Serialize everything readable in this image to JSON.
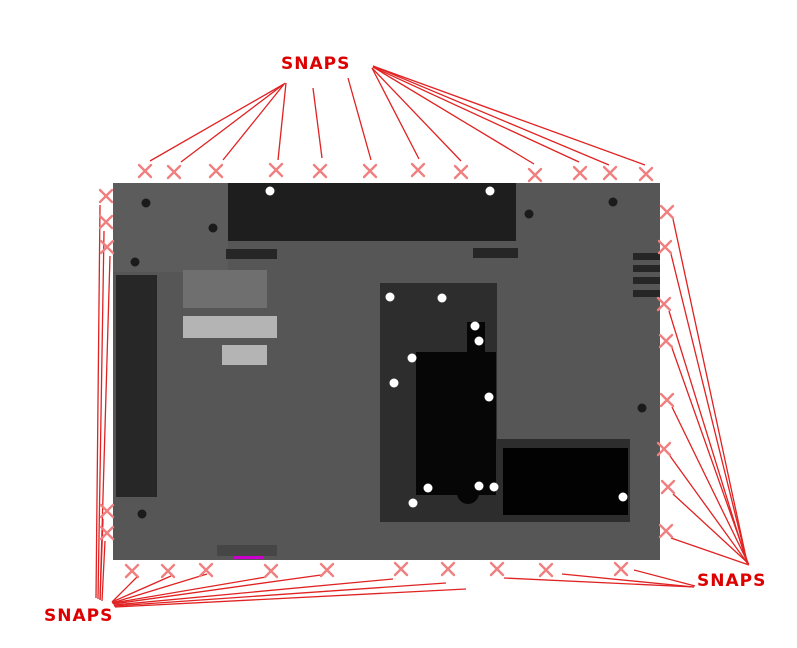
{
  "diagram": {
    "title": "laptop-base-snap-locations",
    "colors": {
      "accent": "#dd0000",
      "marker": "#f08080",
      "leader_line": "#e02222",
      "magenta": "#cc00cc",
      "base_gray": "#565656",
      "component_black": "#060606"
    },
    "labels": {
      "top": "SNAPS",
      "bottom_right": "SNAPS",
      "bottom_left": "SNAPS"
    },
    "snap_markers": {
      "top": [
        [
          145,
          171
        ],
        [
          174,
          172
        ],
        [
          216,
          171
        ],
        [
          276,
          170
        ],
        [
          320,
          171
        ],
        [
          370,
          171
        ],
        [
          418,
          170
        ],
        [
          461,
          172
        ],
        [
          535,
          175
        ],
        [
          580,
          173
        ],
        [
          610,
          173
        ],
        [
          646,
          174
        ]
      ],
      "left": [
        [
          106,
          196
        ],
        [
          106,
          222
        ],
        [
          107,
          247
        ],
        [
          107,
          511
        ],
        [
          107,
          533
        ]
      ],
      "right": [
        [
          667,
          212
        ],
        [
          665,
          247
        ],
        [
          664,
          304
        ],
        [
          666,
          341
        ],
        [
          667,
          400
        ],
        [
          664,
          449
        ],
        [
          668,
          487
        ],
        [
          666,
          531
        ]
      ],
      "bottom": [
        [
          132,
          571
        ],
        [
          168,
          571
        ],
        [
          206,
          570
        ],
        [
          271,
          571
        ],
        [
          327,
          570
        ],
        [
          401,
          569
        ],
        [
          448,
          569
        ],
        [
          497,
          569
        ],
        [
          546,
          570
        ],
        [
          621,
          569
        ]
      ]
    },
    "leader_lines": [
      [
        284,
        84,
        150,
        161
      ],
      [
        284,
        84,
        181,
        162
      ],
      [
        285,
        83,
        223,
        160
      ],
      [
        286,
        83,
        278,
        160
      ],
      [
        313,
        88,
        322,
        158
      ],
      [
        348,
        78,
        371,
        160
      ],
      [
        372,
        68,
        419,
        159
      ],
      [
        372,
        68,
        461,
        161
      ],
      [
        373,
        67,
        534,
        164
      ],
      [
        373,
        67,
        579,
        162
      ],
      [
        373,
        66,
        609,
        165
      ],
      [
        373,
        66,
        645,
        165
      ],
      [
        96,
        598,
        100,
        205
      ],
      [
        98,
        599,
        104,
        231
      ],
      [
        100,
        600,
        110,
        256
      ],
      [
        100,
        600,
        103,
        519
      ],
      [
        102,
        601,
        105,
        541
      ],
      [
        112,
        602,
        137,
        577
      ],
      [
        112,
        602,
        171,
        576
      ],
      [
        112,
        603,
        207,
        574
      ],
      [
        113,
        603,
        266,
        577
      ],
      [
        113,
        604,
        321,
        575
      ],
      [
        114,
        605,
        393,
        579
      ],
      [
        114,
        606,
        446,
        583
      ],
      [
        115,
        607,
        466,
        589
      ],
      [
        747,
        562,
        673,
        219
      ],
      [
        747,
        562,
        671,
        254
      ],
      [
        747,
        563,
        669,
        311
      ],
      [
        748,
        563,
        672,
        348
      ],
      [
        748,
        563,
        672,
        407
      ],
      [
        748,
        564,
        670,
        456
      ],
      [
        749,
        564,
        673,
        494
      ],
      [
        749,
        565,
        671,
        538
      ],
      [
        694,
        587,
        504,
        578
      ],
      [
        694,
        587,
        562,
        574
      ],
      [
        695,
        586,
        634,
        570
      ]
    ],
    "screws": {
      "dark": [
        [
          146,
          203
        ],
        [
          213,
          228
        ],
        [
          135,
          262
        ],
        [
          529,
          214
        ],
        [
          613,
          202
        ],
        [
          642,
          408
        ],
        [
          142,
          514
        ]
      ],
      "light": [
        [
          270,
          191
        ],
        [
          490,
          191
        ],
        [
          390,
          297
        ],
        [
          442,
          298
        ],
        [
          475,
          326
        ],
        [
          479,
          341
        ],
        [
          412,
          358
        ],
        [
          394,
          383
        ],
        [
          489,
          397
        ],
        [
          428,
          488
        ],
        [
          479,
          486
        ],
        [
          494,
          487
        ],
        [
          413,
          503
        ],
        [
          623,
          497
        ]
      ]
    }
  }
}
